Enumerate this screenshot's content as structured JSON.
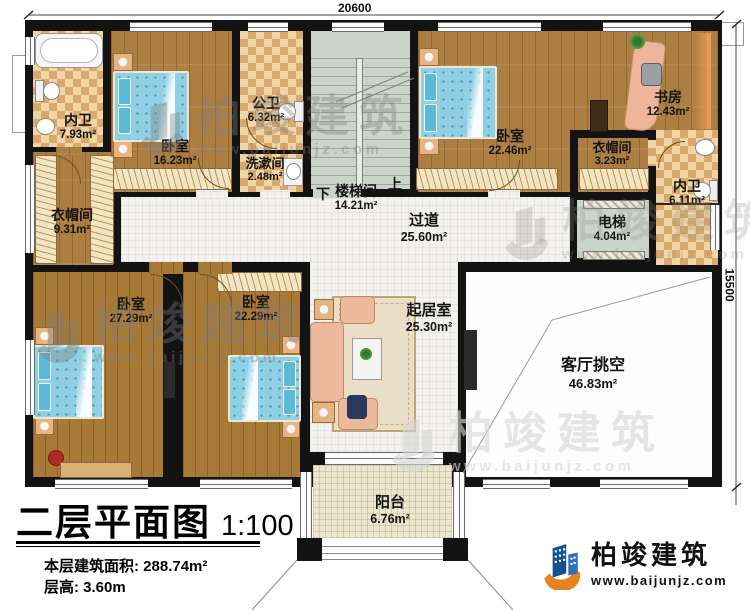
{
  "title_block": {
    "title": "二层平面图",
    "scale": "1:100",
    "floor_area": "本层建筑面积: 288.74m²",
    "floor_height": "层高: 3.60m"
  },
  "dimensions": {
    "width": "20600",
    "height": "15500"
  },
  "stairs": {
    "down": "下",
    "up": "上"
  },
  "rooms": {
    "bath_top_left": {
      "name": "内卫",
      "area": "7.93m²"
    },
    "bedroom_top_left": {
      "name": "卧室",
      "area": "16.23m²"
    },
    "public_bath": {
      "name": "公卫",
      "area": "6.32m²"
    },
    "washroom": {
      "name": "洗漱间",
      "area": "2.48m²"
    },
    "stairwell": {
      "name": "楼梯间",
      "area": "14.21m²"
    },
    "bedroom_top_right": {
      "name": "卧室",
      "area": "22.46m²"
    },
    "study": {
      "name": "书房",
      "area": "12.43m²"
    },
    "cloak_right": {
      "name": "衣帽间",
      "area": "3.23m²"
    },
    "bath_right": {
      "name": "内卫",
      "area": "6.11m²"
    },
    "elevator": {
      "name": "电梯",
      "area": "4.04m²"
    },
    "corridor": {
      "name": "过道",
      "area": "25.60m²"
    },
    "cloak_left": {
      "name": "衣帽间",
      "area": "9.31m²"
    },
    "bedroom_bottom_left": {
      "name": "卧室",
      "area": "27.29m²"
    },
    "bedroom_bottom_mid": {
      "name": "卧室",
      "area": "22.29m²"
    },
    "living": {
      "name": "起居室",
      "area": "25.30m²"
    },
    "void": {
      "name": "客厅挑空",
      "area": "46.83m²"
    },
    "balcony": {
      "name": "阳台",
      "area": "6.76m²"
    }
  },
  "branding": {
    "company": "柏竣建筑",
    "website": "www.baijunjz.com"
  },
  "watermark": {
    "text": "柏竣建筑",
    "url": "www.baijunjz.com"
  },
  "colors": {
    "wall": "#131313",
    "wood": "#ad7e41",
    "tile": "#f3f2ee",
    "checker_dark": "#d9a96b",
    "checker_light": "#f0d6a6",
    "stair": "#cbd4c9",
    "balcony": "#ece6cf",
    "bed": "#8fd0e4",
    "sofa": "#ecb99c",
    "logo_blue": "#1b63a8",
    "logo_orange": "#e8821e"
  }
}
